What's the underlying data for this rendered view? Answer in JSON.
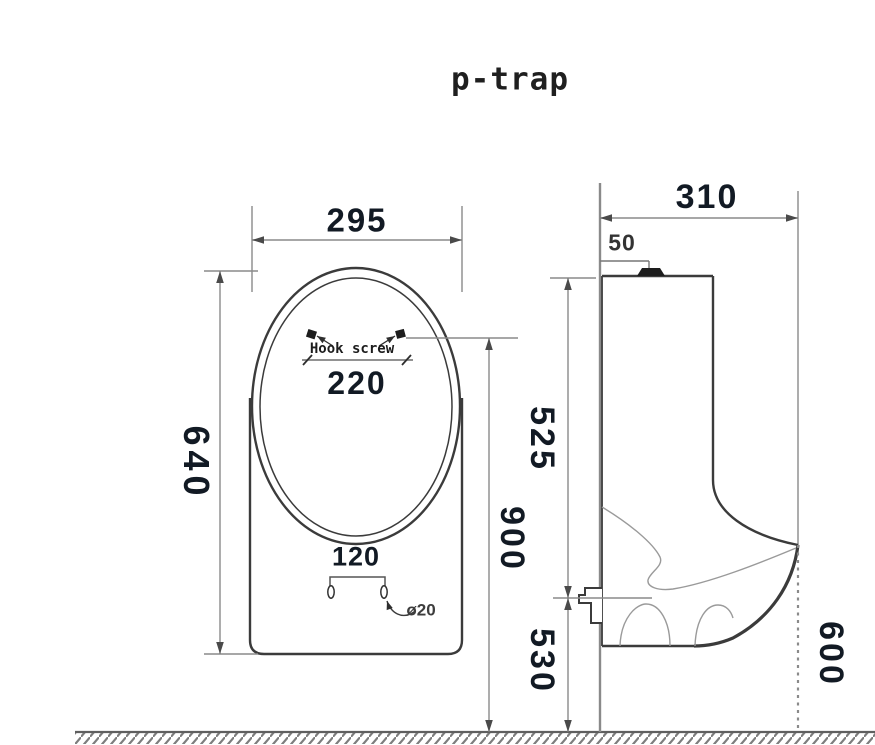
{
  "title": "p-trap",
  "front_view": {
    "width": "295",
    "height": "640",
    "hook_screw_label": "Hook screw",
    "hook_screw_spacing": "220",
    "hook_screw_height_from_floor": "900",
    "drain_hole_spacing": "120",
    "drain_hole_diameter": "ø20"
  },
  "side_view": {
    "depth": "310",
    "inlet_offset_from_wall": "50",
    "rim_to_outlet": "525",
    "outlet_to_floor": "530",
    "spout_lip_to_floor": "600"
  },
  "colors": {
    "object_line": "#3b3b3b",
    "dimension_line": "#8a8a8a",
    "dimension_text": "#121a24",
    "background": "#ffffff"
  }
}
